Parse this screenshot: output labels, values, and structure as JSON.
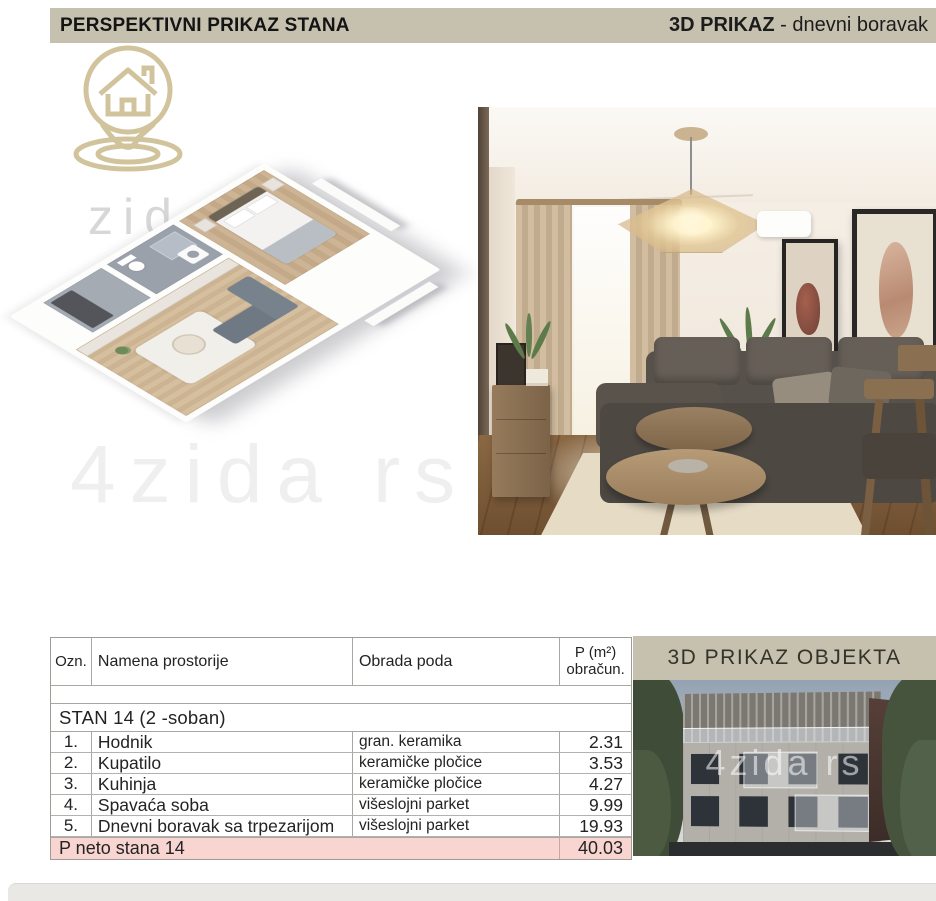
{
  "header": {
    "left_title": "PERSPEKTIVNI PRIKAZ STANA",
    "right_title_bold": "3D PRIKAZ",
    "right_title_rest": " - dnevni boravak"
  },
  "sections": {
    "building_title": "3D PRIKAZ OBJEKTA"
  },
  "watermarks": {
    "plan_text": "zida",
    "mid_text": "4zida rs",
    "building_text": "4zida rs"
  },
  "table": {
    "headers": {
      "ozn": "Ozn.",
      "namena": "Namena prostorije",
      "obrada": "Obrada poda",
      "p_line1": "P (m²)",
      "p_line2": "obračun."
    },
    "group_title": "STAN 14  (2 -soban)",
    "rows": [
      {
        "ozn": "1.",
        "namena": "Hodnik",
        "obrada": "gran. keramika",
        "p": "2.31"
      },
      {
        "ozn": "2.",
        "namena": "Kupatilo",
        "obrada": "keramičke pločice",
        "p": "3.53"
      },
      {
        "ozn": "3.",
        "namena": "Kuhinja",
        "obrada": "keramičke pločice",
        "p": "4.27"
      },
      {
        "ozn": "4.",
        "namena": "Spavaća soba",
        "obrada": "višeslojni parket",
        "p": "9.99"
      },
      {
        "ozn": "5.",
        "namena": "Dnevni boravak sa trpezarijom",
        "obrada": "višeslojni parket",
        "p": "19.93"
      }
    ],
    "total": {
      "label": "P neto stana 14",
      "value": "40.03"
    }
  },
  "colors": {
    "header_bg": "#c6c0af",
    "total_row_bg": "#f8d5d1",
    "logo_gold": "#c9ba8d",
    "sofa_dark": "#57514b",
    "wood_floor": "#7a5c3e"
  }
}
